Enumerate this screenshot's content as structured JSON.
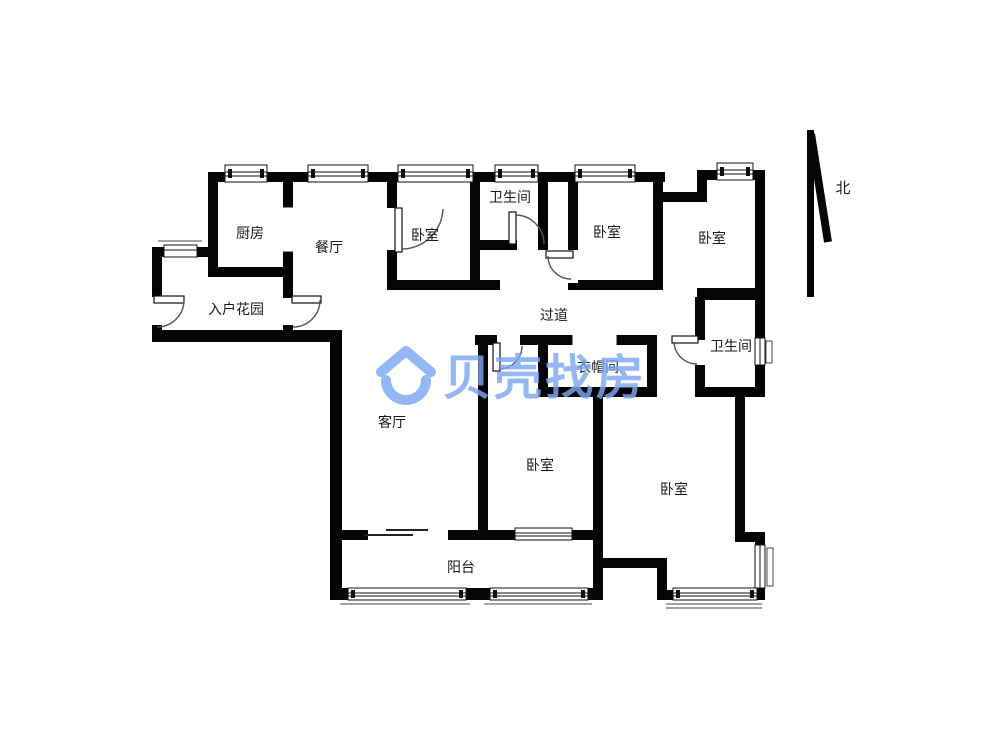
{
  "floorplan": {
    "rooms": [
      {
        "id": "kitchen",
        "label": "厨房"
      },
      {
        "id": "dining",
        "label": "餐厅"
      },
      {
        "id": "bedroom-top-left",
        "label": "卧室"
      },
      {
        "id": "bathroom-top",
        "label": "卫生间"
      },
      {
        "id": "bedroom-top-mid",
        "label": "卧室"
      },
      {
        "id": "bedroom-top-right",
        "label": "卧室"
      },
      {
        "id": "entry-garden",
        "label": "入户花园"
      },
      {
        "id": "corridor",
        "label": "过道"
      },
      {
        "id": "cloakroom",
        "label": "衣帽间"
      },
      {
        "id": "bathroom-right",
        "label": "卫生间"
      },
      {
        "id": "living-room",
        "label": "客厅"
      },
      {
        "id": "bedroom-bottom-mid",
        "label": "卧室"
      },
      {
        "id": "bedroom-bottom-right",
        "label": "卧室"
      },
      {
        "id": "balcony",
        "label": "阳台"
      }
    ],
    "compass": {
      "label": "北"
    },
    "watermark": {
      "text": "贝壳找房",
      "color": "#7CA7F2"
    },
    "colors": {
      "wall": "#050505",
      "text": "#1a1a1a",
      "thin_line": "#555555"
    }
  }
}
